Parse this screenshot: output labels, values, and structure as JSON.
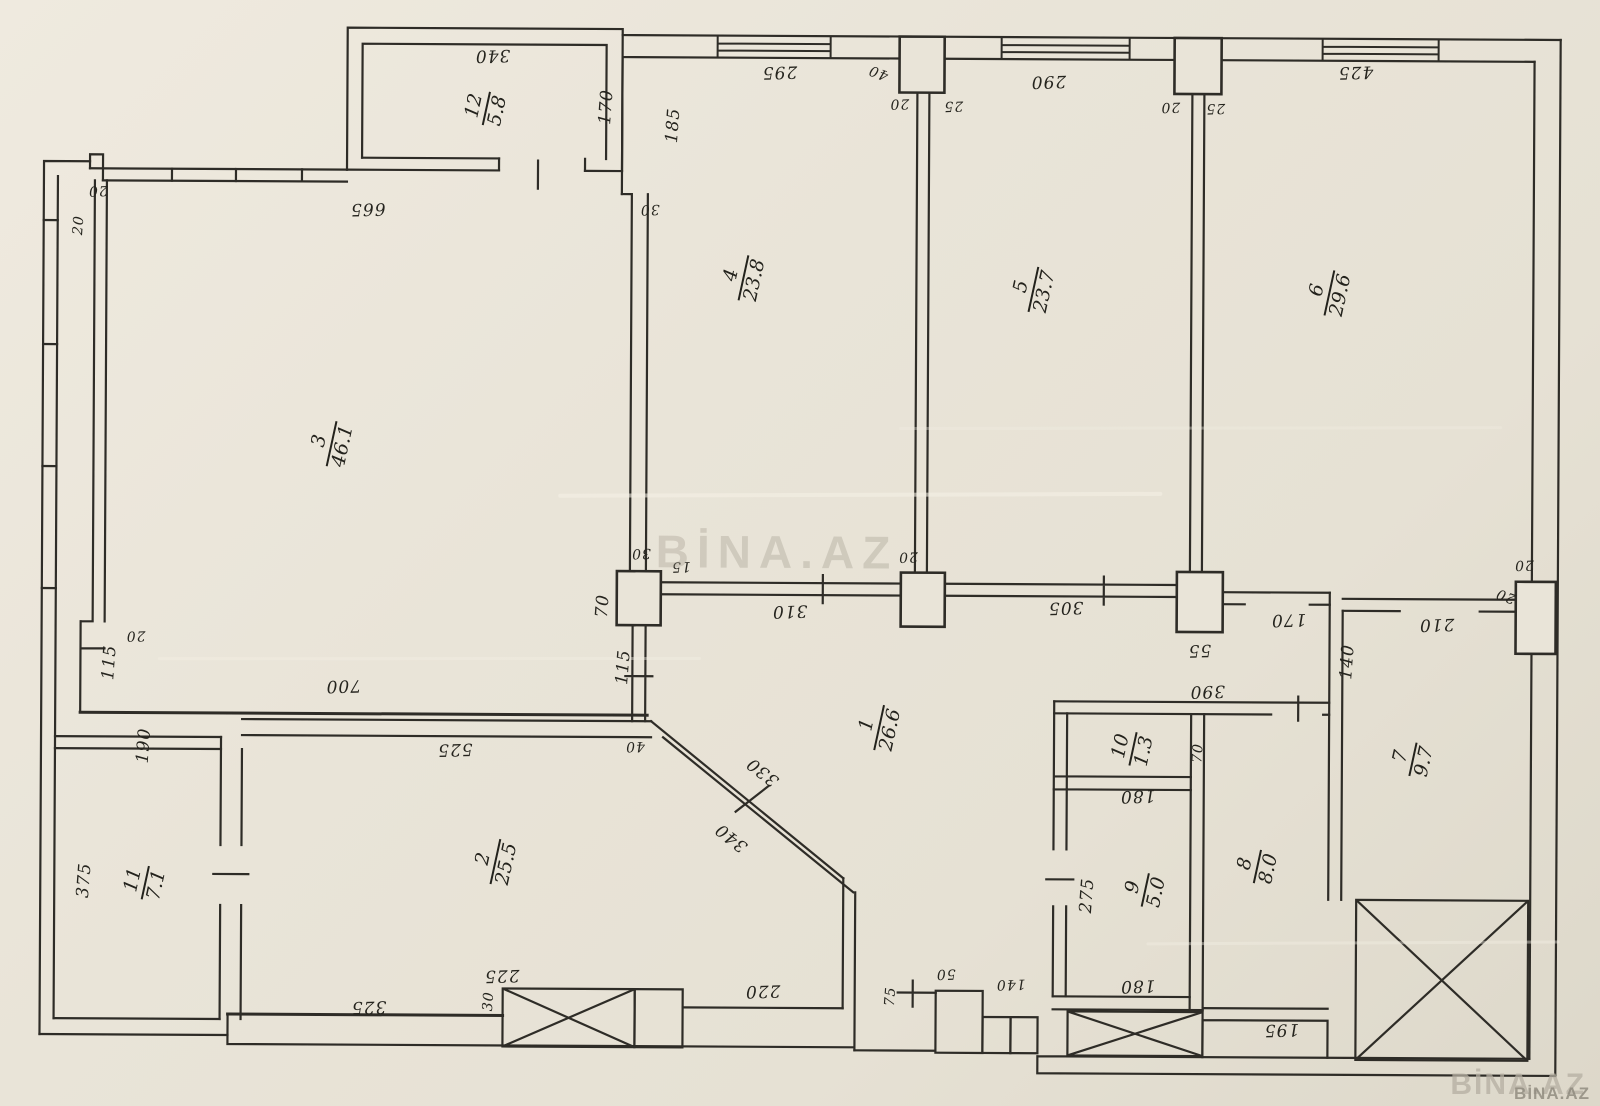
{
  "title": "Scanned apartment floor plan",
  "watermarks": {
    "center": "BİNA.AZ",
    "corner_large": "BİNA.AZ",
    "corner_small": "BİNA.AZ"
  },
  "rooms": [
    {
      "number": "12",
      "area": "5.8"
    },
    {
      "number": "3",
      "area": "46.1"
    },
    {
      "number": "4",
      "area": "23.8"
    },
    {
      "number": "5",
      "area": "23.7"
    },
    {
      "number": "6",
      "area": "29.6"
    },
    {
      "number": "1",
      "area": "26.6"
    },
    {
      "number": "2",
      "area": "25.5"
    },
    {
      "number": "11",
      "area": "7.1"
    },
    {
      "number": "10",
      "area": "1.3"
    },
    {
      "number": "9",
      "area": "5.0"
    },
    {
      "number": "8",
      "area": "8.0"
    },
    {
      "number": "7",
      "area": "9.7"
    }
  ],
  "dims": [
    "340",
    "170",
    "665",
    "20",
    "20",
    "295",
    "185",
    "30",
    "40",
    "20",
    "25",
    "290",
    "20",
    "25",
    "425",
    "20",
    "20",
    "310",
    "30",
    "15",
    "70",
    "115",
    "20",
    "305",
    "55",
    "170",
    "390",
    "70",
    "180",
    "210",
    "140",
    "700",
    "20",
    "115",
    "190",
    "375",
    "525",
    "40",
    "330",
    "340",
    "325",
    "30",
    "225",
    "220",
    "75",
    "50",
    "140",
    "180",
    "195",
    "275"
  ]
}
